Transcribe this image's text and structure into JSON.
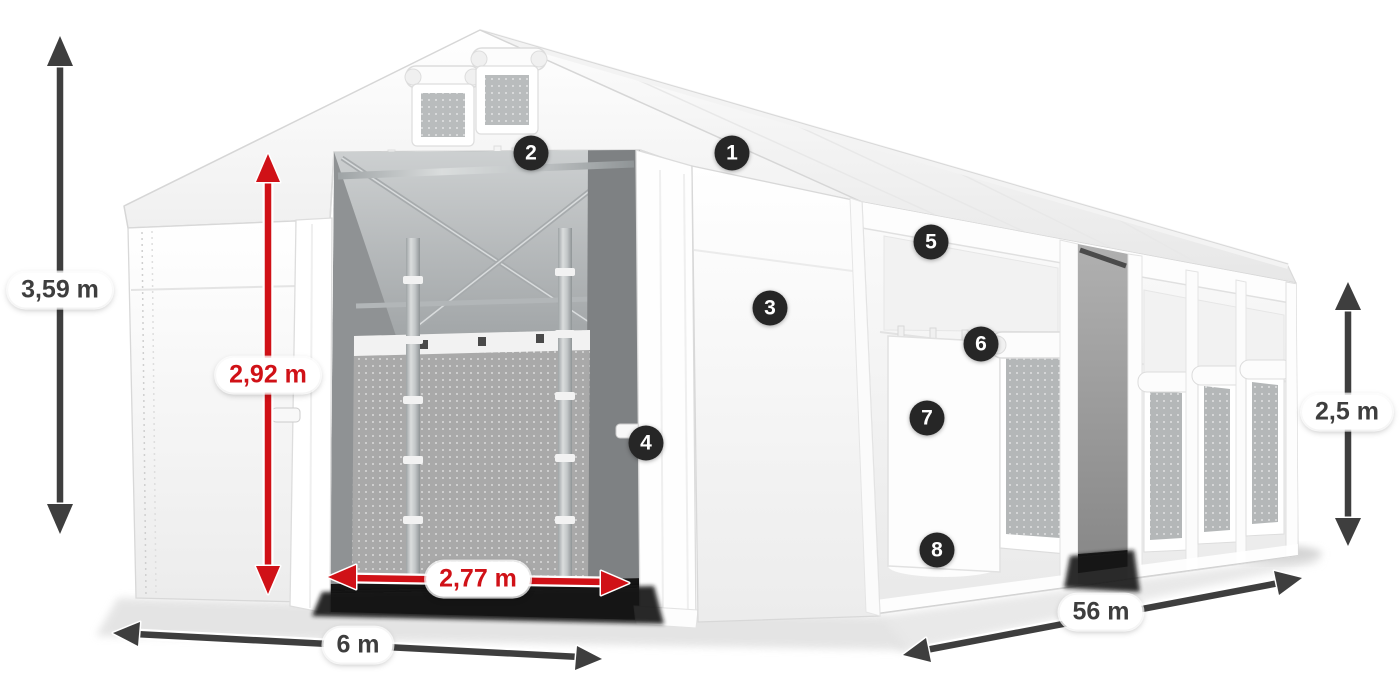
{
  "dimensions": {
    "total_height": "3,59 m",
    "entrance_height": "2,92 m",
    "entrance_width": "2,77 m",
    "gable_width": "6 m",
    "length": "56 m",
    "side_wall_height": "2,5 m"
  },
  "callouts": [
    {
      "number": "1"
    },
    {
      "number": "2"
    },
    {
      "number": "3"
    },
    {
      "number": "4"
    },
    {
      "number": "5"
    },
    {
      "number": "6"
    },
    {
      "number": "7"
    },
    {
      "number": "8"
    }
  ],
  "colors": {
    "background": "#ffffff",
    "dimension_dark": "#3e3e3e",
    "dimension_red": "#d01117",
    "pill_background": "#ffffff",
    "badge_background": "#262626",
    "badge_text": "#ffffff",
    "tent_white": "#fbfbfb",
    "tent_outline": "#d6d6d6",
    "interior_gray": "#a9a9a9"
  }
}
